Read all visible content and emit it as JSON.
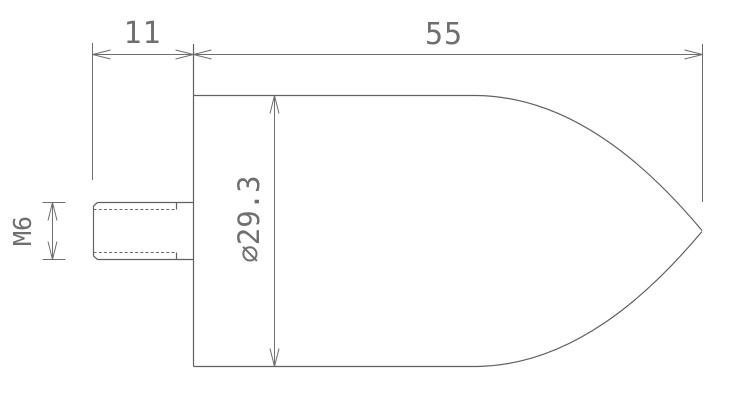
{
  "drawing": {
    "type": "technical-dimension-drawing",
    "part": "pointed bullet-nose plunger with threaded stud",
    "labels": {
      "stud_length": "11",
      "overall_length": "55",
      "thread_size": "M6",
      "body_diameter": "⌀29.3"
    },
    "colors": {
      "background": "#ffffff",
      "outline": "#616161",
      "dimension": "#6e6e6e",
      "text": "#6f6f6f"
    }
  }
}
